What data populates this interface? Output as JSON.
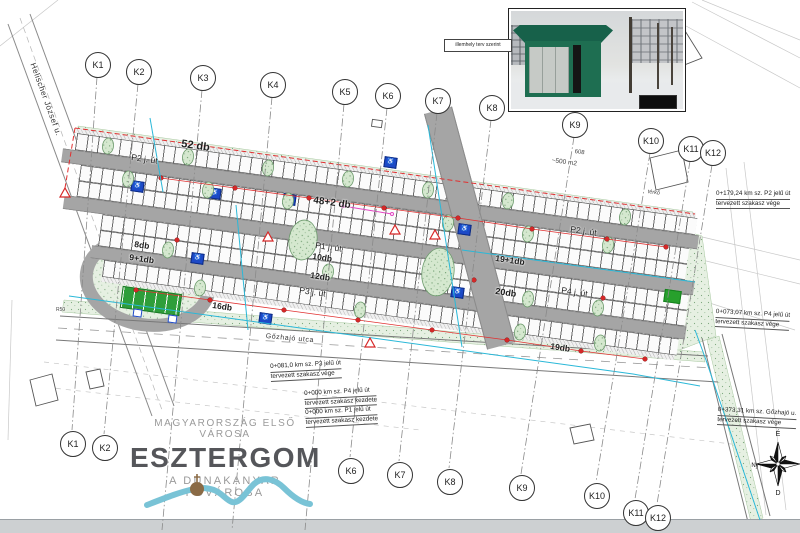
{
  "photo_inset": {
    "label": "illemhely terv szerint"
  },
  "k_markers": {
    "top": [
      "K1",
      "K2",
      "K3",
      "K4",
      "K5",
      "K6",
      "K7",
      "K8",
      "K9",
      "K10",
      "K11",
      "K12"
    ],
    "bottom": [
      "K1",
      "K2",
      "K6",
      "K7",
      "K8",
      "K9",
      "K10",
      "K11",
      "K12"
    ]
  },
  "plan": {
    "roads": {
      "p2_left": "P2 j. út",
      "p2_right": "P2 j. út",
      "p1": "P1 j. út",
      "p3": "P3 j. út",
      "p4": "P4 j. út"
    },
    "counts": {
      "row_a": "52 db",
      "row_b": "48+2 db",
      "b_right": "19+1db",
      "c1_left": "8db",
      "c2_left": "9+1db",
      "c_mid1": "10db",
      "c_mid2": "12db",
      "c_right": "20db",
      "d_left": "16db",
      "d_right": "19db"
    }
  },
  "streets": {
    "helischer": "Helischer József u.",
    "gozhajo": "Gőzhajó utca"
  },
  "misc": {
    "area": "~500 m2",
    "n608": "608",
    "terko": "térkő",
    "r50": "R50"
  },
  "annotations": {
    "a1": {
      "l1": "0+179,24 km sz. P2 jelű út",
      "l2": "tervezett szakasz vége"
    },
    "a2": {
      "l1": "0+073,07 km sz. P4 jelű út",
      "l2": "tervezett szakasz vége"
    },
    "a3": {
      "l1": "0+373,31 km sz. Gőzhajó u.",
      "l2": "tervezett szakasz vége"
    },
    "a4": {
      "l1": "0+081,0 km sz. P3 jelű út",
      "l2": "tervezett szakasz vége"
    },
    "a5": {
      "l1": "0+000 km sz. P4 jelű út",
      "l2": "tervezett szakasz kezdete",
      "l3": "0+000 km sz. P1 jelű út",
      "l4": "tervezett szakasz kezdete"
    }
  },
  "logo": {
    "line1": "MAGYARORSZÁG ELSŐ VÁROSA",
    "name": "ESZTERGOM",
    "line3": "A DUNAKANYAR FŐVÁROSA"
  },
  "compass": {
    "n": "É",
    "e": "K",
    "s": "D",
    "w": "Ny"
  },
  "icons": {
    "wheelchair": "♿"
  },
  "colors": {
    "road": "#a5a5a5",
    "grass": "#e6f0e2",
    "grass_dot": "#7fa87f",
    "cyan": "#2ab8d8",
    "red": "#e03131",
    "blue_sign": "#1d49c8",
    "green_stall": "#2e9e3a",
    "magenta": "#e245c2",
    "logo_gray": "#9a9a9a",
    "logo_dark": "#55565a",
    "ribbon": "#79c3d6",
    "dome": "#8a6a45",
    "kiosk_green": "#1d6b4f"
  }
}
